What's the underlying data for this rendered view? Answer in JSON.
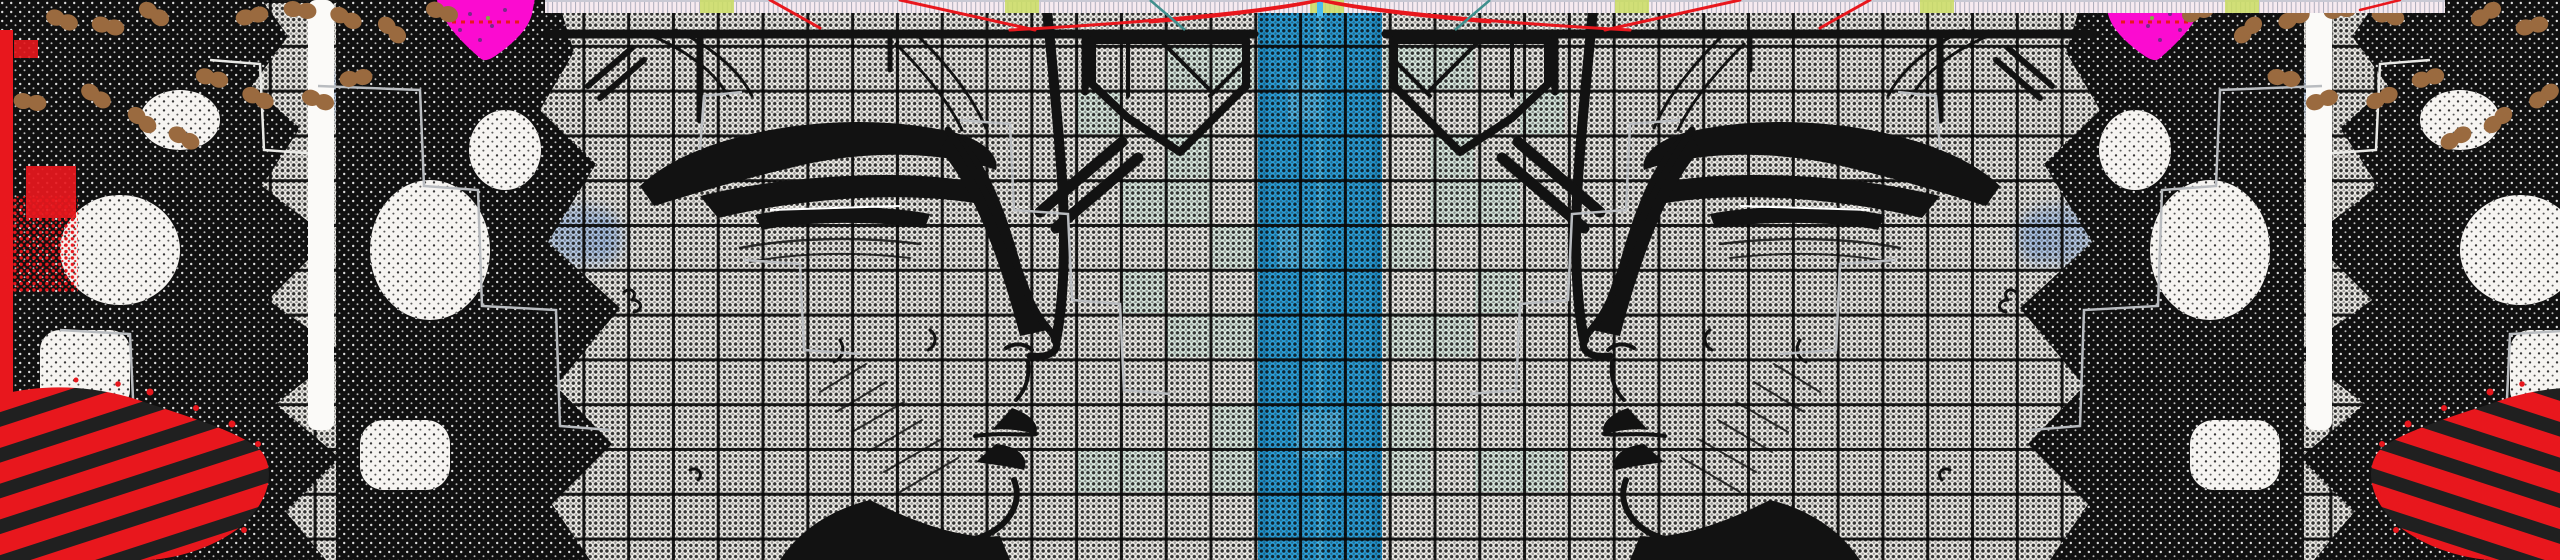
{
  "meta": {
    "kind": "abstract-glitch-collage-banner",
    "alt": "Mirrored abstract collage: two charcoal-sketched face profiles facing a central halftone blue stripe over a black grid, with circuit linework, brown peanut-shaped dot chains, magenta blobs, red corner brush strokes and a fine top ruler strip with red fan lines. No text is present.",
    "width_px": 2560,
    "height_px": 560,
    "visible_text": ""
  },
  "colors": {
    "paper": "#f6f4ef",
    "ink": "#121212",
    "stripe_blue": "#2aa5e2",
    "stripe_edge": "#1d93cf",
    "stripe_light": "#55bdec",
    "center_line": "#49bdf0",
    "mint": "#e1f1e7",
    "watercolor": "#a9c4ea",
    "red": "#e8171d",
    "brush_dark": "#202020",
    "magenta": "#fb0bd0",
    "brown": "#9a6a3f",
    "ruler_bg": "#f6eaf0",
    "ruler_tick": "#8f93a6",
    "ruler_green": "#cadd61",
    "ruler_teal": "#3f8f8d",
    "trace_gray": "#b9bcc0",
    "white_band": "#fbfaf8"
  },
  "layout_data": {
    "mirror_axis_x": 1320,
    "blue_stripe": {
      "x": 1258,
      "width": 124
    },
    "center_line": {
      "x": 1317,
      "width": 6
    },
    "ruler_band": {
      "x": 545,
      "width": 1900,
      "height": 13
    },
    "grid_cell_px": 44.8,
    "halftone_pitch_px": 5.6
  },
  "patches": [
    {
      "kind": "stripe",
      "x": 1258,
      "y": 0,
      "w": 124,
      "h": 560
    },
    {
      "kind": "stripe-dark",
      "x": 1258,
      "y": 0,
      "w": 10,
      "h": 560
    },
    {
      "kind": "stripe-dark",
      "x": 1372,
      "y": 0,
      "w": 10,
      "h": 560
    },
    {
      "kind": "stripe-light",
      "x": 1288,
      "y": 80,
      "w": 36,
      "h": 40
    },
    {
      "kind": "stripe-light",
      "x": 1278,
      "y": 224,
      "w": 42,
      "h": 44
    },
    {
      "kind": "stripe-light",
      "x": 1296,
      "y": 412,
      "w": 44,
      "h": 46
    },
    {
      "kind": "center-line",
      "x": 1317,
      "y": 13,
      "w": 6,
      "h": 547
    },
    {
      "kind": "mint",
      "x": 1166,
      "y": 45,
      "w": 90,
      "h": 44,
      "mirror": 2640
    },
    {
      "kind": "mint",
      "x": 1076,
      "y": 90,
      "w": 44,
      "h": 44,
      "mirror": 2640
    },
    {
      "kind": "mint",
      "x": 1166,
      "y": 134,
      "w": 44,
      "h": 44,
      "mirror": 2640
    },
    {
      "kind": "mint",
      "x": 1121,
      "y": 179,
      "w": 89,
      "h": 44,
      "mirror": 2640
    },
    {
      "kind": "mint",
      "x": 1210,
      "y": 224,
      "w": 45,
      "h": 44,
      "mirror": 2640
    },
    {
      "kind": "mint",
      "x": 1121,
      "y": 269,
      "w": 44,
      "h": 44,
      "mirror": 2640
    },
    {
      "kind": "mint",
      "x": 1166,
      "y": 313,
      "w": 89,
      "h": 44,
      "mirror": 2640
    },
    {
      "kind": "mint",
      "x": 1210,
      "y": 403,
      "w": 45,
      "h": 89,
      "mirror": 2640
    },
    {
      "kind": "mint",
      "x": 1076,
      "y": 448,
      "w": 89,
      "h": 44,
      "mirror": 2640
    },
    {
      "kind": "watercolor",
      "x": 86,
      "y": 50,
      "w": 115,
      "h": 52,
      "mirror": 2640
    },
    {
      "kind": "watercolor",
      "x": 330,
      "y": 56,
      "w": 132,
      "h": 76,
      "mirror": 2640
    },
    {
      "kind": "watercolor",
      "x": 418,
      "y": 226,
      "w": 116,
      "h": 80,
      "mirror": 2640
    },
    {
      "kind": "watercolor",
      "x": 546,
      "y": 206,
      "w": 68,
      "h": 58,
      "mirror": 2640
    },
    {
      "kind": "watercolor",
      "x": 68,
      "y": 112,
      "w": 48,
      "h": 42,
      "mirror": 2640
    },
    {
      "kind": "watercolor",
      "x": 588,
      "y": 214,
      "w": 34,
      "h": 48,
      "mirror": 2640
    }
  ],
  "peanuts": {
    "note": "peanut-shaped brown dot pairs, upper-left field, mirrored to upper-right",
    "items": [
      [
        62,
        20,
        20
      ],
      [
        108,
        26,
        12
      ],
      [
        154,
        14,
        32
      ],
      [
        252,
        16,
        -12
      ],
      [
        300,
        10,
        8
      ],
      [
        346,
        18,
        24
      ],
      [
        392,
        30,
        42
      ],
      [
        442,
        12,
        18
      ],
      [
        96,
        96,
        34
      ],
      [
        142,
        120,
        40
      ],
      [
        212,
        78,
        14
      ],
      [
        258,
        98,
        24
      ],
      [
        318,
        100,
        18
      ],
      [
        356,
        78,
        -8
      ],
      [
        30,
        102,
        8
      ],
      [
        184,
        138,
        28
      ]
    ]
  }
}
